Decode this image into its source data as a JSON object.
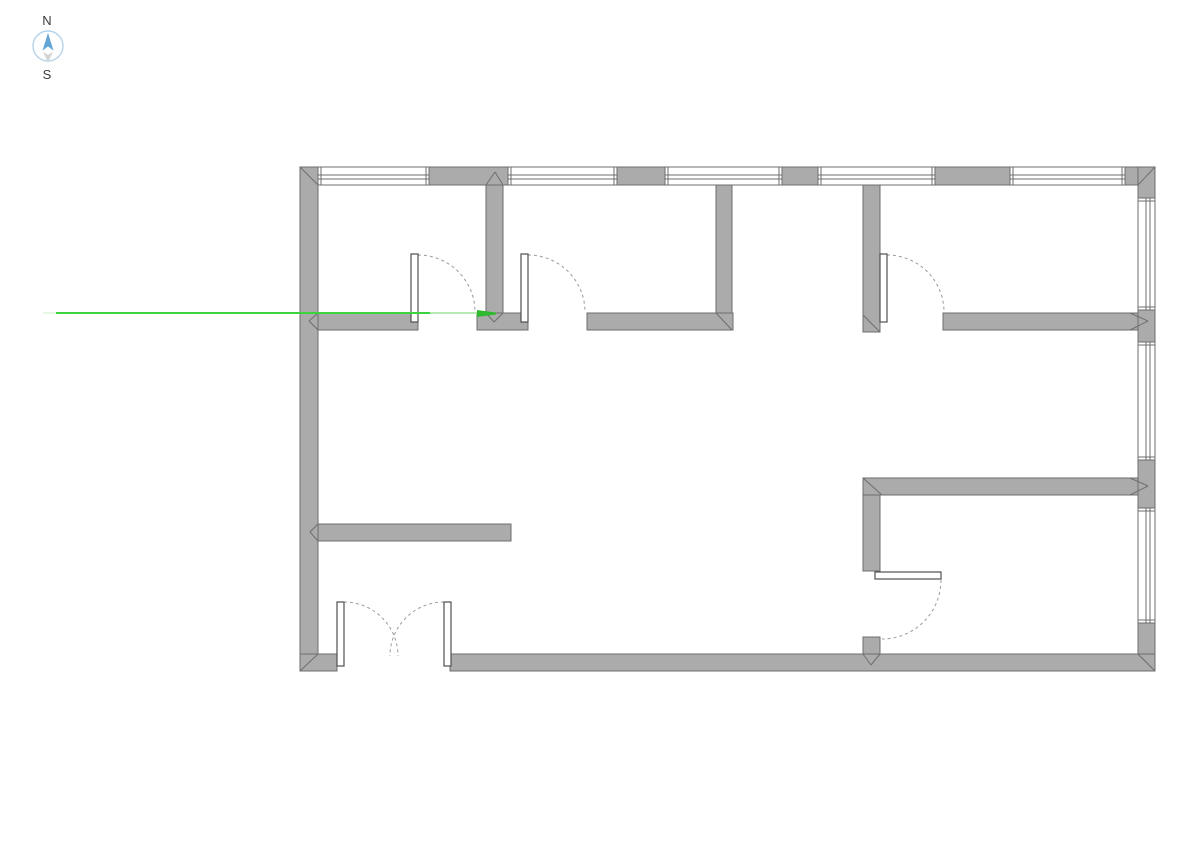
{
  "app": {
    "background_color": "#ffffff"
  },
  "compass": {
    "north_label": "N",
    "south_label": "S",
    "label_color": "#3c3c3c",
    "label_font_size": 13,
    "cx": 48,
    "cy": 46,
    "r": 15,
    "circle_color": "#b5d3ea",
    "needle_north_color": "#64a5d8",
    "needle_south_color": "#d4d4d4",
    "needle_north_points": "48,33 53.5,50.5 48,46.5 42.5,50.5",
    "needle_south_points": "43,51.5 48,55 53,51.5 48,62.5",
    "north_label_x": 47,
    "north_label_y": 25,
    "south_label_x": 47,
    "south_label_y": 79
  },
  "reference_line": {
    "y": 313,
    "color_bright": "#3fd23f",
    "color_faded": "#b5eab5",
    "color_over_wall": "#2fb92f",
    "color_start_ticks": "#c9f0c9",
    "segments": [
      {
        "name": "reference-line-start-tick",
        "x1": 43,
        "x2": 56,
        "y": 313,
        "color_key": "color_start_ticks",
        "width": 1
      },
      {
        "name": "reference-line-main",
        "x1": 56,
        "x2": 430,
        "y": 313,
        "color_key": "color_bright",
        "width": 2
      },
      {
        "name": "reference-line-faded",
        "x1": 430,
        "x2": 477,
        "y": 313,
        "color_key": "color_faded",
        "width": 2
      }
    ],
    "end_polygon": {
      "name": "reference-line-end-over-wall",
      "points": "477,310 496,312.5 496,314.5 477,317",
      "color_key": "color_over_wall"
    }
  },
  "floor_plan": {
    "wall_fill": "#ababab",
    "wall_edge": "#6e6e6e",
    "window_fill": "#ffffff",
    "window_line": "#6e6e6e",
    "door_leaf_fill": "#ffffff",
    "door_leaf_edge": "#4f4f4f",
    "door_arc_color": "#9a9a9a",
    "walls": [
      {
        "name": "exterior-wall-left",
        "x": 300,
        "y": 167,
        "w": 18,
        "h": 504
      },
      {
        "name": "exterior-wall-top-pier-1",
        "x": 429,
        "y": 167,
        "w": 79,
        "h": 18
      },
      {
        "name": "exterior-wall-top-pier-2",
        "x": 617,
        "y": 167,
        "w": 48,
        "h": 18
      },
      {
        "name": "exterior-wall-top-pier-3",
        "x": 782,
        "y": 167,
        "w": 36,
        "h": 18
      },
      {
        "name": "exterior-wall-top-pier-4",
        "x": 935,
        "y": 167,
        "w": 75,
        "h": 18
      },
      {
        "name": "exterior-wall-top-corner",
        "x": 1125,
        "y": 167,
        "w": 30,
        "h": 18
      },
      {
        "name": "exterior-wall-right-seg-1",
        "x": 1138,
        "y": 167,
        "w": 17,
        "h": 31
      },
      {
        "name": "exterior-wall-right-seg-2",
        "x": 1138,
        "y": 310,
        "w": 17,
        "h": 32
      },
      {
        "name": "exterior-wall-right-seg-3",
        "x": 1138,
        "y": 460,
        "w": 17,
        "h": 48
      },
      {
        "name": "exterior-wall-right-seg-4",
        "x": 1138,
        "y": 623,
        "w": 17,
        "h": 48
      },
      {
        "name": "exterior-wall-bottom-left",
        "x": 300,
        "y": 654,
        "w": 37,
        "h": 17
      },
      {
        "name": "exterior-wall-bottom-main",
        "x": 450,
        "y": 654,
        "w": 705,
        "h": 17
      },
      {
        "name": "partition-wall-h1-a",
        "x": 318,
        "y": 313,
        "w": 100,
        "h": 17
      },
      {
        "name": "partition-wall-h1-b",
        "x": 477,
        "y": 313,
        "w": 51,
        "h": 17
      },
      {
        "name": "partition-wall-h1-c",
        "x": 587,
        "y": 313,
        "w": 146,
        "h": 17
      },
      {
        "name": "partition-wall-v1",
        "x": 486,
        "y": 185,
        "w": 17,
        "h": 128
      },
      {
        "name": "partition-wall-v2",
        "x": 716,
        "y": 185,
        "w": 16,
        "h": 128
      },
      {
        "name": "partition-wall-v3",
        "x": 863,
        "y": 185,
        "w": 17,
        "h": 147
      },
      {
        "name": "partition-wall-h2",
        "x": 943,
        "y": 313,
        "w": 195,
        "h": 17
      },
      {
        "name": "partition-wall-h3",
        "x": 318,
        "y": 524,
        "w": 193,
        "h": 17
      },
      {
        "name": "partition-wall-h4",
        "x": 863,
        "y": 478,
        "w": 275,
        "h": 17
      },
      {
        "name": "partition-wall-v4",
        "x": 863,
        "y": 495,
        "w": 17,
        "h": 76
      },
      {
        "name": "partition-wall-v4-stub",
        "x": 863,
        "y": 637,
        "w": 17,
        "h": 17
      }
    ],
    "windows": [
      {
        "name": "window-top-1",
        "x": 318,
        "y": 167,
        "w": 111,
        "h": 18,
        "orient": "h"
      },
      {
        "name": "window-top-2",
        "x": 508,
        "y": 167,
        "w": 109,
        "h": 18,
        "orient": "h"
      },
      {
        "name": "window-top-3",
        "x": 665,
        "y": 167,
        "w": 117,
        "h": 18,
        "orient": "h"
      },
      {
        "name": "window-top-4",
        "x": 818,
        "y": 167,
        "w": 117,
        "h": 18,
        "orient": "h"
      },
      {
        "name": "window-top-5",
        "x": 1010,
        "y": 167,
        "w": 115,
        "h": 18,
        "orient": "h"
      },
      {
        "name": "window-right-1",
        "x": 1138,
        "y": 198,
        "w": 17,
        "h": 112,
        "orient": "v"
      },
      {
        "name": "window-right-2",
        "x": 1138,
        "y": 342,
        "w": 17,
        "h": 118,
        "orient": "v"
      },
      {
        "name": "window-right-3",
        "x": 1138,
        "y": 508,
        "w": 17,
        "h": 115,
        "orient": "v"
      }
    ],
    "door_leaves": [
      {
        "name": "door-1-leaf",
        "x": 411,
        "y": 254,
        "w": 7,
        "h": 68
      },
      {
        "name": "door-2-leaf",
        "x": 521,
        "y": 254,
        "w": 7,
        "h": 68
      },
      {
        "name": "door-3-leaf",
        "x": 880,
        "y": 254,
        "w": 7,
        "h": 68
      },
      {
        "name": "door-4-leaf",
        "x": 875,
        "y": 572,
        "w": 66,
        "h": 7
      },
      {
        "name": "double-door-left-leaf",
        "x": 337,
        "y": 602,
        "w": 7,
        "h": 64
      },
      {
        "name": "double-door-right-leaf",
        "x": 444,
        "y": 602,
        "w": 7,
        "h": 64
      }
    ],
    "door_arcs": [
      {
        "name": "door-1-swing",
        "d": "M418,255 A57,57 0 0 1 475,312"
      },
      {
        "name": "door-2-swing",
        "d": "M528,255 A57,57 0 0 1 585,312"
      },
      {
        "name": "door-3-swing",
        "d": "M887,255 A57,57 0 0 1 944,312"
      },
      {
        "name": "door-4-swing",
        "d": "M941,580 A59,59 0 0 1 882,639"
      },
      {
        "name": "double-door-left-swing",
        "d": "M344,602 A54,54 0 0 1 398,656"
      },
      {
        "name": "double-door-right-swing",
        "d": "M444,602 A54,54 0 0 0 390,656"
      }
    ],
    "miter_joints": [
      {
        "name": "miter-corner-top-left",
        "x1": 300,
        "y1": 167,
        "x2": 318,
        "y2": 185
      },
      {
        "name": "miter-corner-bottom-left",
        "x1": 318,
        "y1": 654,
        "x2": 300,
        "y2": 671
      },
      {
        "name": "miter-corner-top-right",
        "x1": 1138,
        "y1": 185,
        "x2": 1155,
        "y2": 167
      },
      {
        "name": "miter-corner-bottom-right",
        "x1": 1138,
        "y1": 654,
        "x2": 1155,
        "y2": 671
      },
      {
        "name": "miter-v1-top-a",
        "x1": 486,
        "y1": 185,
        "x2": 495,
        "y2": 172
      },
      {
        "name": "miter-v1-top-b",
        "x1": 503,
        "y1": 185,
        "x2": 495,
        "y2": 172
      },
      {
        "name": "miter-h1-left-a",
        "x1": 318,
        "y1": 313,
        "x2": 309,
        "y2": 321
      },
      {
        "name": "miter-h1-left-b",
        "x1": 318,
        "y1": 330,
        "x2": 309,
        "y2": 321
      },
      {
        "name": "miter-v1-bottom-a",
        "x1": 486,
        "y1": 313,
        "x2": 494,
        "y2": 322
      },
      {
        "name": "miter-v1-bottom-b",
        "x1": 503,
        "y1": 313,
        "x2": 494,
        "y2": 322
      },
      {
        "name": "miter-v2-h1-corner",
        "x1": 716,
        "y1": 313,
        "x2": 732,
        "y2": 330
      },
      {
        "name": "miter-v3-end",
        "x1": 863,
        "y1": 315,
        "x2": 880,
        "y2": 332
      },
      {
        "name": "miter-h2-right-a",
        "x1": 1130,
        "y1": 313,
        "x2": 1148,
        "y2": 321
      },
      {
        "name": "miter-h2-right-b",
        "x1": 1130,
        "y1": 330,
        "x2": 1148,
        "y2": 321
      },
      {
        "name": "miter-h4-right-a",
        "x1": 1130,
        "y1": 478,
        "x2": 1148,
        "y2": 486
      },
      {
        "name": "miter-h4-right-b",
        "x1": 1130,
        "y1": 495,
        "x2": 1148,
        "y2": 486
      },
      {
        "name": "miter-h4-v4-corner",
        "x1": 863,
        "y1": 478,
        "x2": 882,
        "y2": 495
      },
      {
        "name": "miter-stub-bottom-a",
        "x1": 863,
        "y1": 654,
        "x2": 871,
        "y2": 665
      },
      {
        "name": "miter-stub-bottom-b",
        "x1": 880,
        "y1": 654,
        "x2": 871,
        "y2": 665
      },
      {
        "name": "miter-h3-left-a",
        "x1": 318,
        "y1": 524,
        "x2": 310,
        "y2": 532
      },
      {
        "name": "miter-h3-left-b",
        "x1": 318,
        "y1": 541,
        "x2": 310,
        "y2": 532
      }
    ]
  }
}
